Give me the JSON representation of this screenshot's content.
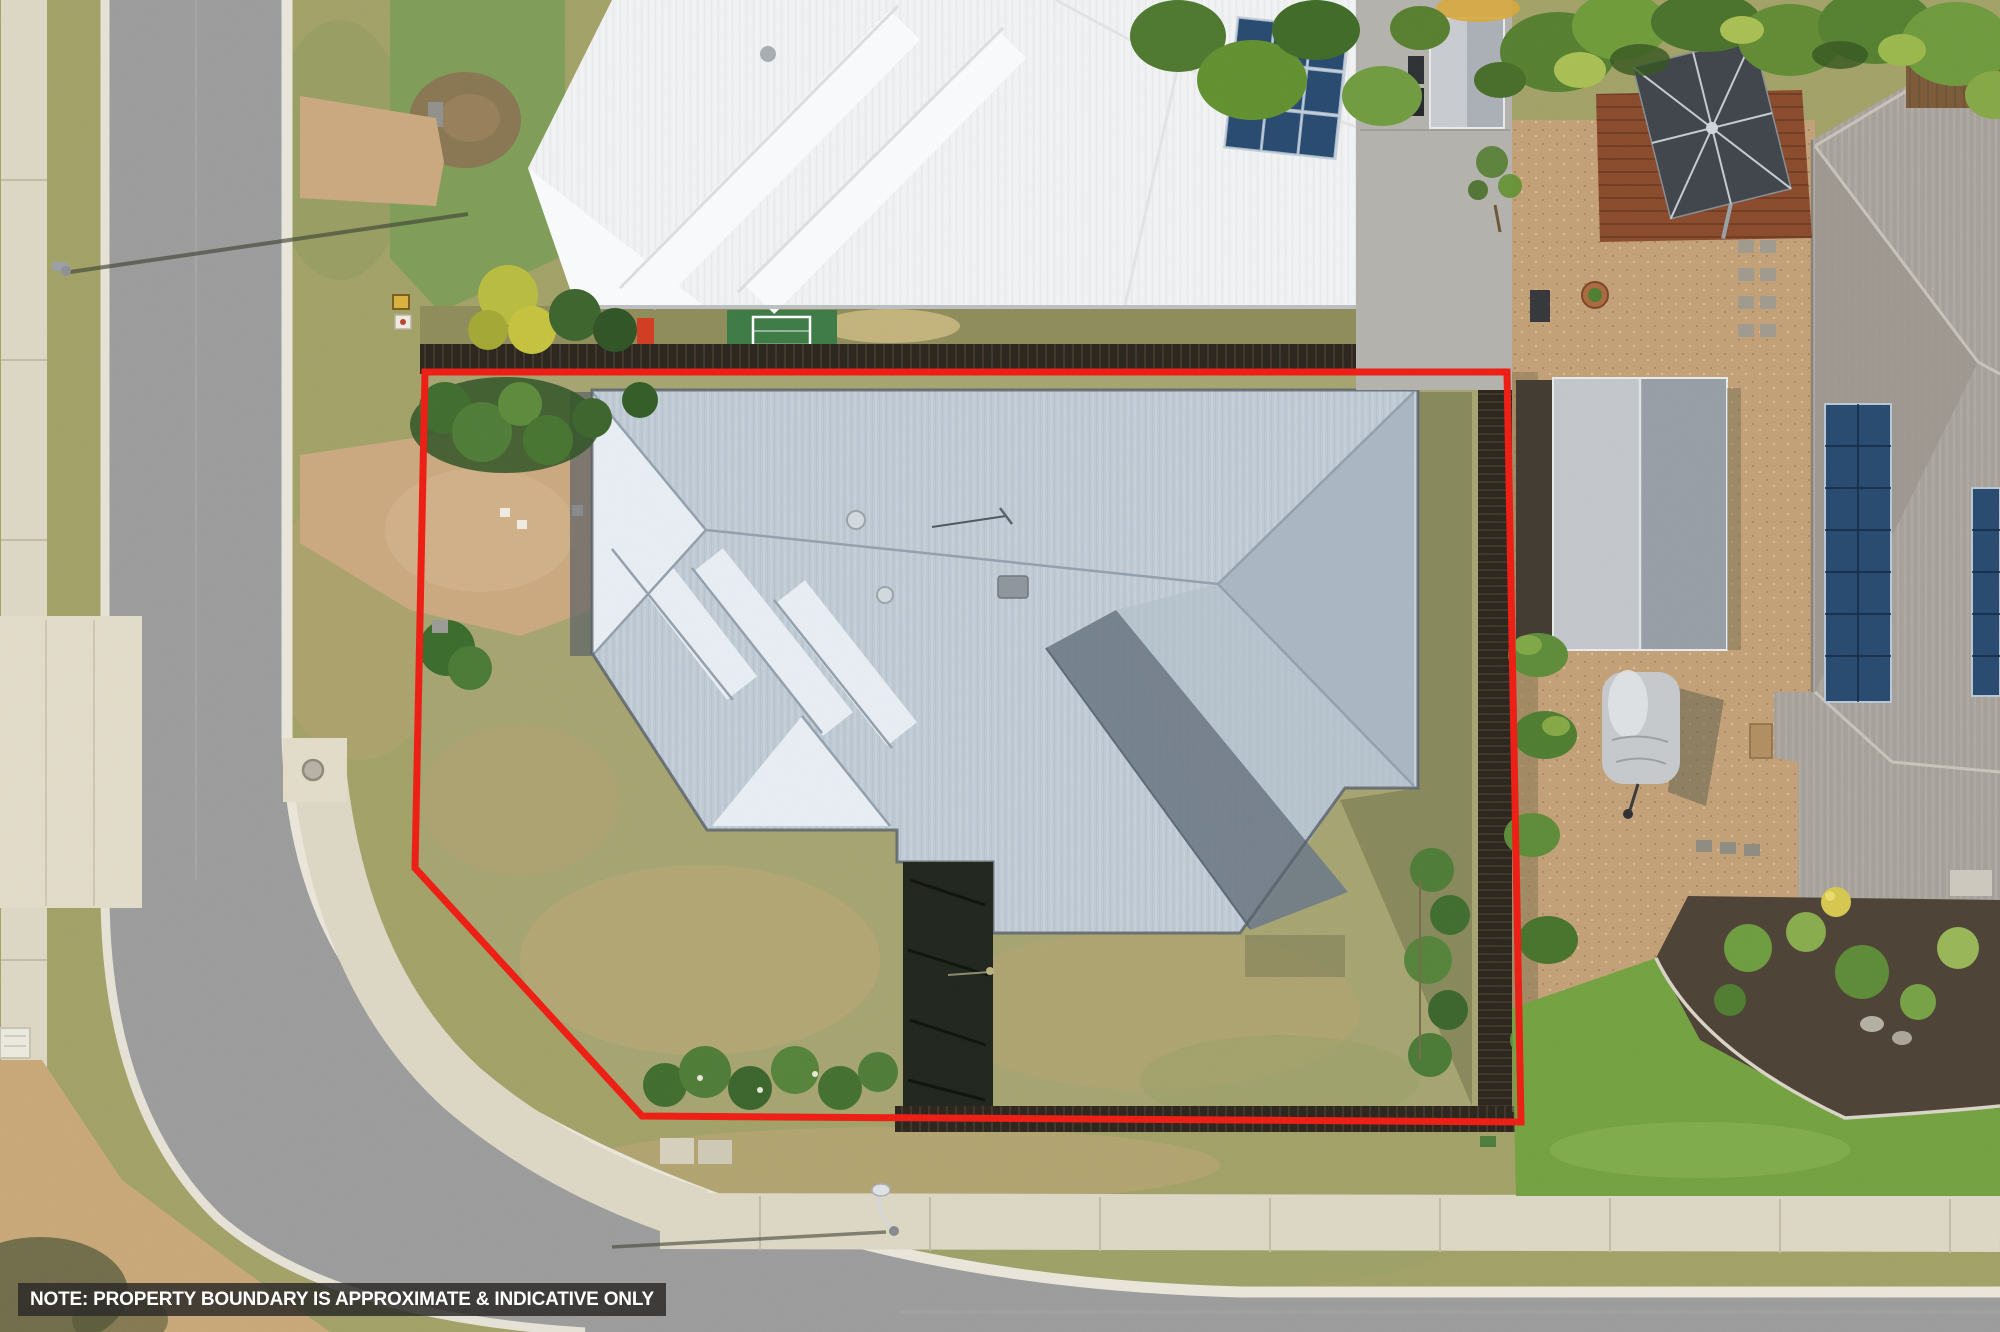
{
  "note": {
    "text": "NOTE: PROPERTY BOUNDARY IS APPROXIMATE & INDICATIVE ONLY"
  },
  "boundary": {
    "color": "#ee1c12",
    "points": "425,372 1507,372 1521,1122 642,1116 415,868",
    "closed": true,
    "stroke_width": 7
  },
  "colors": {
    "road": "#9c9c9c",
    "curb": "#eae6da",
    "footpath": "#ddd7c4",
    "driveway_tan": "#cba87f",
    "verge_grass": "#a2a167",
    "lot_lawn": "#a6a470",
    "lawn_bright": "#73a23f",
    "grass_green": "#7f9d57",
    "roof_subject": "#bfcad4",
    "roof_subject_light": "#e8eef3",
    "roof_subject_dark": "#6f7b87",
    "roof_white": "#f1f2f3",
    "roof_neighbor": "#a8a29b",
    "solar_panel": "#27496f",
    "fence_dark": "#2a241c",
    "gravel": "#c3a077",
    "garden_mulch": "#4c4134",
    "deck_timber": "#8a4a2b",
    "umbrella_dark": "#3f444a",
    "trampoline_mat": "#3c7a44",
    "play_red": "#d23b20",
    "play_yellow": "#e7b31e"
  },
  "scene": {
    "type": "aerial-drone-photo",
    "subject": "residential lot outlined in red",
    "features": [
      "corner road",
      "footpaths",
      "subject hipped metal roof",
      "white roof neighbour house",
      "neighbour house with solar panels",
      "garden shed",
      "covered car",
      "palm trees",
      "cantilever umbrella",
      "timber fences",
      "street lights",
      "trampoline mat with soccer goal"
    ]
  }
}
